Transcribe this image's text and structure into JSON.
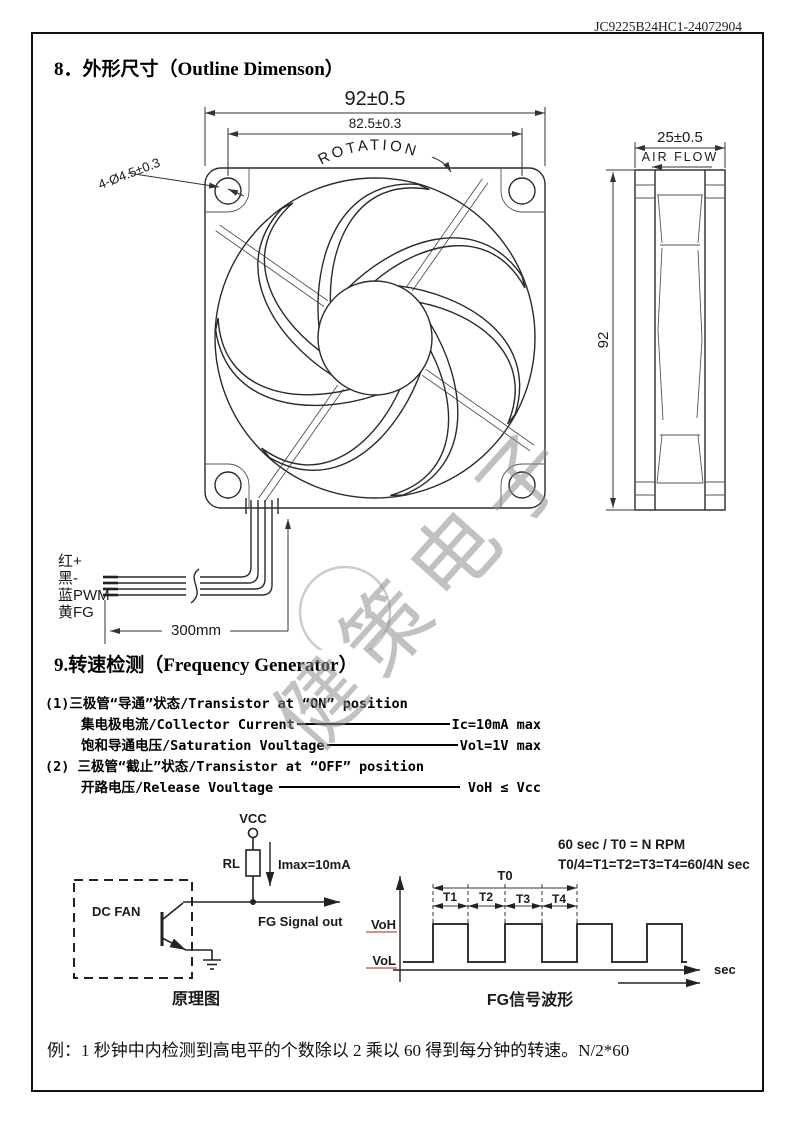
{
  "page": {
    "doc_number": "JC9225B24HC1-24072904",
    "watermark": "健策电子",
    "note": "例：1 秒钟中内检测到高电平的个数除以 2 乘以 60 得到每分钟的转速。N/2*60"
  },
  "section8": {
    "title": "8．外形尺寸（Outline Dimenson）",
    "front_view": {
      "dim_width": "92±0.5",
      "dim_hole_pitch": "82.5±0.3",
      "rotation_label": "ROTATION",
      "hole_callout": "4-Ø4.5±0.3"
    },
    "side_view": {
      "dim_depth": "25±0.5",
      "airflow_label": "AIR FLOW",
      "dim_height": "92"
    },
    "wires": {
      "red": "红+",
      "black": "黑-",
      "blue": "蓝PWM",
      "yellow": "黄FG",
      "length": "300mm"
    }
  },
  "section9": {
    "title": "9.转速检测（Frequency Generator）",
    "line1": "(1)三极管“导通”状态/Transistor at “ON” position",
    "line2": {
      "label": "集电极电流/Collector Current",
      "value": "Ic=10mA max"
    },
    "line3": {
      "label": "饱和导通电压/Saturation Voultage",
      "value": "Vol=1V max"
    },
    "line4": "(2) 三极管“截止”状态/Transistor at “OFF” position",
    "line5": {
      "label": "开路电压/Release Voultage",
      "value": "VoH ≤ Vcc"
    }
  },
  "circuit": {
    "vcc": "VCC",
    "rl": "RL",
    "imax": "Imax=10mA",
    "dc_fan": "DC FAN",
    "fg_out": "FG Signal out",
    "caption": "原理图"
  },
  "waveform": {
    "formula_rpm": "60 sec / T0 = N   RPM",
    "formula_t": "T0/4=T1=T2=T3=T4=60/4N  sec",
    "t0": "T0",
    "t1": "T1",
    "t2": "T2",
    "t3": "T3",
    "t4": "T4",
    "voh": "VoH",
    "vol": "VoL",
    "sec": "sec",
    "caption": "FG信号波形"
  }
}
